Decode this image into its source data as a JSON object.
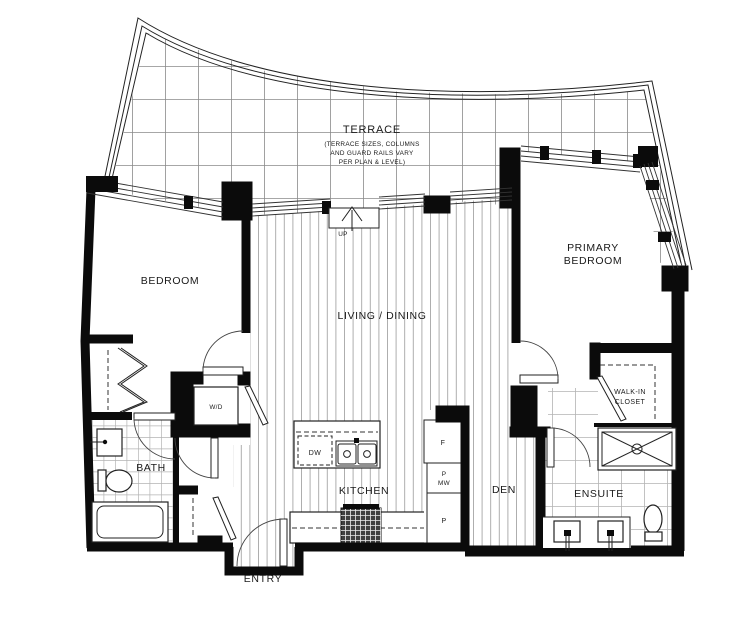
{
  "labels": {
    "terrace": "TERRACE",
    "terrace_note1": "(TERRACE SIZES, COLUMNS",
    "terrace_note2": "AND GUARD RAILS VARY",
    "terrace_note3": "PER PLAN & LEVEL)",
    "bedroom": "BEDROOM",
    "living_dining": "LIVING / DINING",
    "primary_line1": "PRIMARY",
    "primary_line2": "BEDROOM",
    "kitchen": "KITCHEN",
    "den": "DEN",
    "bath": "BATH",
    "ensuite": "ENSUITE",
    "entry": "ENTRY",
    "walkin_line1": "WALK-IN",
    "walkin_line2": "CLOSET",
    "wd": "W/D",
    "dw": "DW",
    "fridge": "F",
    "pantry_top_line1": "P",
    "pantry_top_line2": "MW",
    "pantry_bottom": "P",
    "up": "UP"
  },
  "colors": {
    "wall": "#0b0b0b",
    "plank_hatch": "#9a9a9a",
    "terrace_grid": "#8a8a8a",
    "tile_grid": "#b3b3b3",
    "background": "#ffffff"
  }
}
